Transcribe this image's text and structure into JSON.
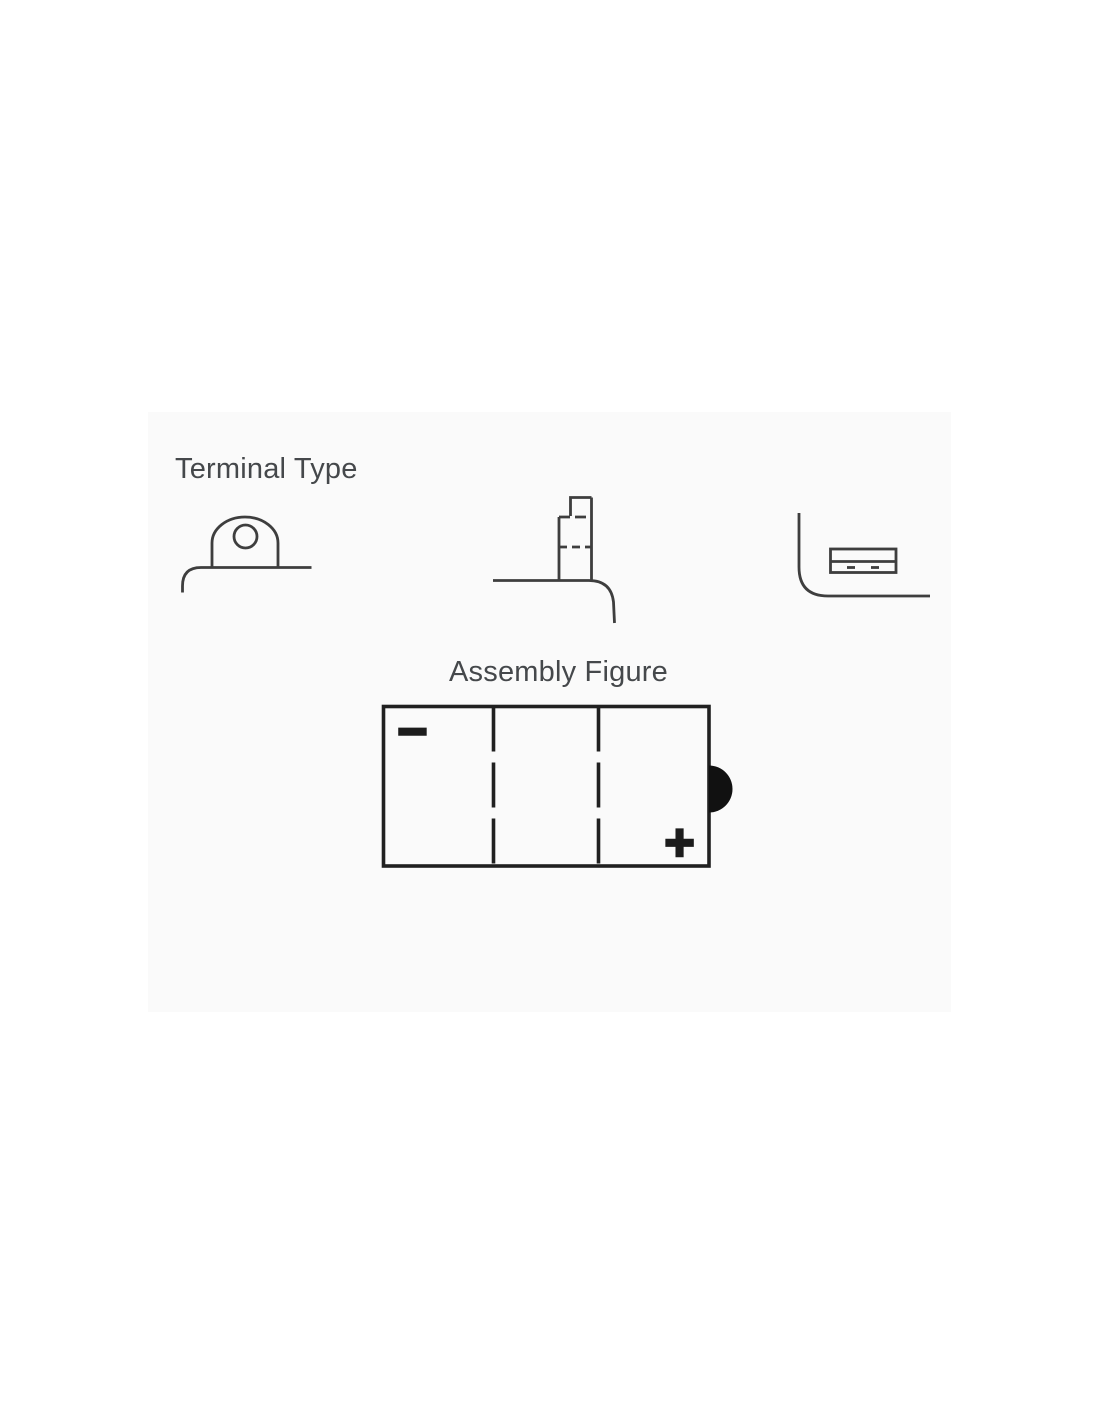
{
  "page": {
    "background_color": "#ffffff",
    "panel_background_color": "#fafafa"
  },
  "terminal_type": {
    "title": "Terminal Type",
    "line_color": "#3e3e3e",
    "variants": [
      {
        "name": "flag-terminal-with-bolt-hole"
      },
      {
        "name": "stepped-post-terminal"
      },
      {
        "name": "flat-recessed-terminal"
      }
    ]
  },
  "assembly_figure": {
    "title": "Assembly Figure",
    "line_color": "#202020",
    "cells": 3,
    "negative_symbol": "−",
    "positive_symbol": "+",
    "negative_position": "top-left",
    "positive_position": "bottom-right",
    "side_bump_position": "right-edge"
  },
  "text_color": "#45484b"
}
